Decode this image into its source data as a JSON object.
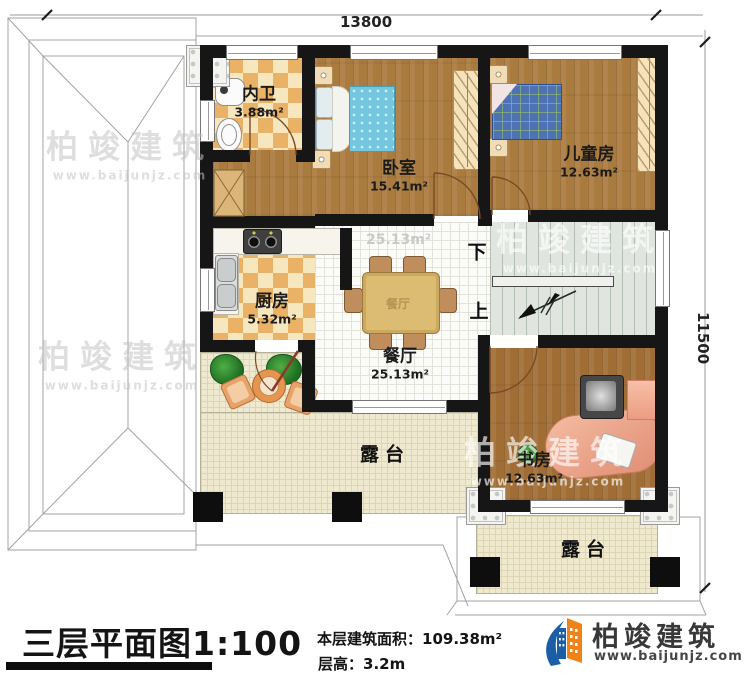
{
  "dimensions": {
    "top": "13800",
    "right": "11500"
  },
  "rooms": {
    "bathroom": {
      "label": "内卫",
      "area": "3.88m²"
    },
    "bedroom": {
      "label": "卧室",
      "area": "15.41m²"
    },
    "kids_room": {
      "label": "儿童房",
      "area": "12.63m²"
    },
    "kitchen": {
      "label": "厨房",
      "area": "5.32m²"
    },
    "dining": {
      "label": "餐厅",
      "area": "25.13m²",
      "area_faint": "25.13m²",
      "table_watermark": "餐厅"
    },
    "study": {
      "label": "书房",
      "area": "12.63m²"
    },
    "terrace_left": {
      "label": "露台"
    },
    "terrace_bottom": {
      "label": "露台"
    }
  },
  "stairs": {
    "down_label": "下",
    "up_label": "上"
  },
  "title_block": {
    "title": "三层平面图",
    "scale": "1:100",
    "floor_area_label": "本层建筑面积：",
    "floor_area_value": "109.38m²",
    "floor_height_label": "层高：",
    "floor_height_value": "3.2m"
  },
  "brand": {
    "name": "柏竣建筑",
    "website": "www.baijunjz.com"
  },
  "watermark": {
    "text": "柏竣建筑",
    "url": "www.baijunjz.com"
  },
  "colors": {
    "wall": "#161616",
    "wood_floor": "#aa7b3e",
    "checker_dark": "#e9b267",
    "checker_light": "#f7e7bf",
    "dining_tile": "#fbfbf7",
    "terrace_tile": "#efe9cf",
    "stairs_floor": "#e0e6df",
    "bed_blue": "#74c7df",
    "kids_bed_blue": "#4e73b4",
    "desk_salmon": "#e8a58d",
    "brand_blue": "#1b5ea6",
    "brand_orange": "#f08318"
  }
}
